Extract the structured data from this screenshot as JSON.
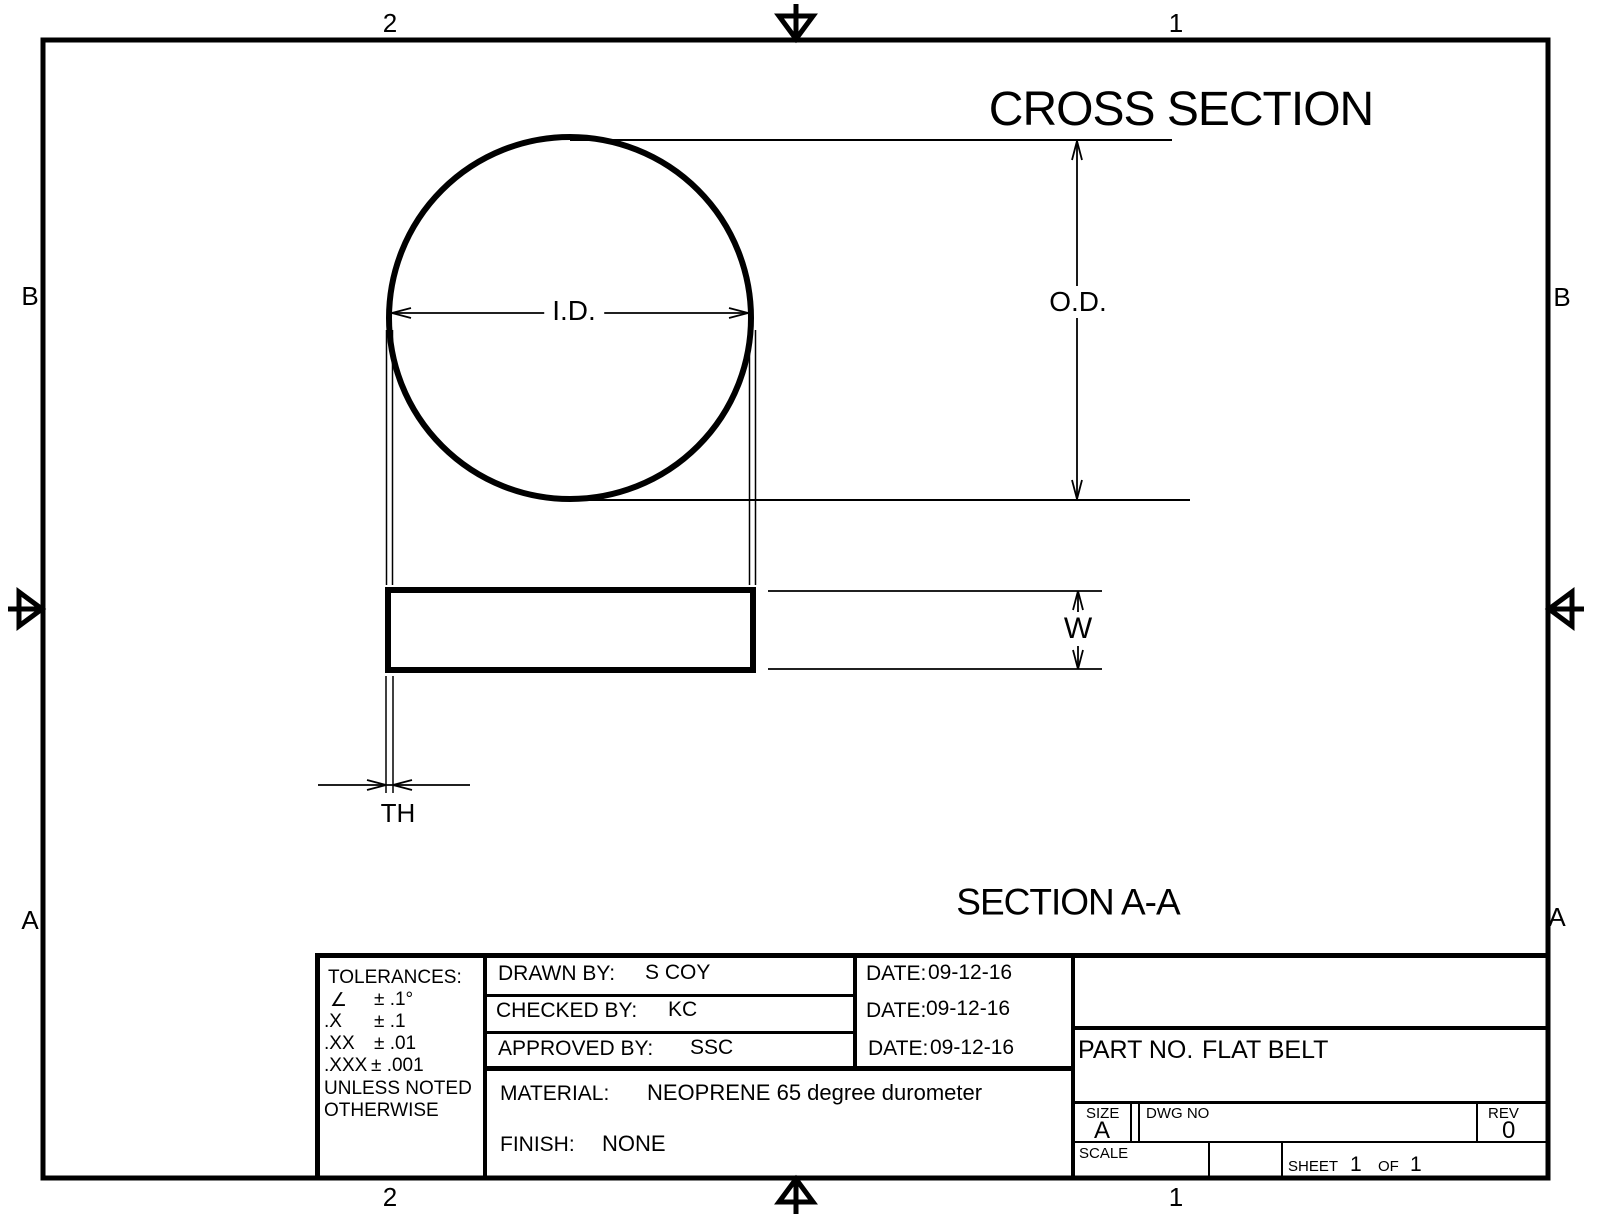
{
  "zones": {
    "top_left": "2",
    "top_right": "1",
    "bottom_left": "2",
    "bottom_right": "1",
    "left_upper": "B",
    "right_upper": "B",
    "left_lower": "A",
    "right_lower": "A"
  },
  "drawing": {
    "view_title": "CROSS SECTION",
    "section_label": "SECTION A-A",
    "dims": {
      "id": "I.D.",
      "od": "O.D.",
      "w": "W",
      "th": "TH"
    }
  },
  "title_block": {
    "tolerances": {
      "header": "TOLERANCES:",
      "rows": [
        {
          "sym": "∠",
          "val": "± .1°"
        },
        {
          "sym": ".X",
          "val": "± .1"
        },
        {
          "sym": ".XX",
          "val": "± .01"
        },
        {
          "sym": ".XXX",
          "val": "± .001"
        }
      ],
      "note1": "UNLESS NOTED",
      "note2": "OTHERWISE"
    },
    "drawn": {
      "label": "DRAWN BY:",
      "value": "S COY",
      "date_label": "DATE:",
      "date": "09-12-16"
    },
    "checked": {
      "label": "CHECKED BY:",
      "value": "KC",
      "date_label": "DATE:",
      "date": "09-12-16"
    },
    "approved": {
      "label": "APPROVED BY:",
      "value": "SSC",
      "date_label": "DATE:",
      "date": "09-12-16"
    },
    "material": {
      "label": "MATERIAL:",
      "value": "NEOPRENE 65 degree durometer"
    },
    "finish": {
      "label": "FINISH:",
      "value": "NONE"
    },
    "part_no": {
      "label": "PART NO.",
      "value": "FLAT BELT"
    },
    "size": {
      "label": "SIZE",
      "value": "A"
    },
    "dwg_no": {
      "label": "DWG NO",
      "value": ""
    },
    "rev": {
      "label": "REV",
      "value": "0"
    },
    "scale": {
      "label": "SCALE",
      "value": ""
    },
    "sheet": {
      "label": "SHEET",
      "page": "1",
      "of_label": "OF",
      "total": "1"
    }
  },
  "colors": {
    "line": "#000000",
    "background": "#ffffff"
  }
}
